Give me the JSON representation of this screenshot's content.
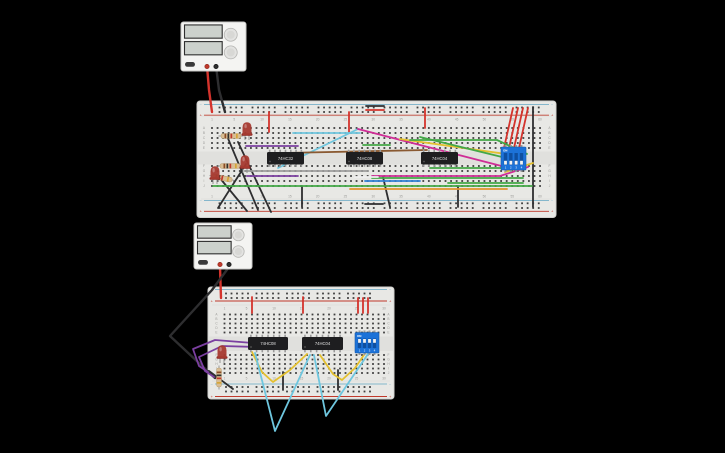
{
  "scene": {
    "width": 725,
    "height": 453,
    "background": "#000000"
  },
  "colors": {
    "board": "#e8e8e5",
    "board_edge": "#d2d2cf",
    "channel": "#e0e0dd",
    "hole": "#3f3f3f",
    "rail_red": "#c0392b",
    "rail_blue": "#85b7cc",
    "label": "#9b9b98",
    "divider": "#d9d9d6",
    "ic_body": "#1e1e20",
    "ic_pin": "#9a9a9a",
    "ic_label": "#e0e0e0",
    "dip_body": "#1c72d8",
    "dip_slot": "#0e4fa0",
    "dip_slider": "#f2f2f2",
    "dip_text": "#ffffff",
    "led_body": "#a63a30",
    "led_flange": "#8c2520",
    "led_lead": "#8a8a8a",
    "resistor_body": "#d9bd93",
    "resistor_lead": "#9a9a9a",
    "psu_body": "#f4f4f2",
    "psu_edge": "#c9c9c6",
    "psu_display": "#ccd1cc",
    "psu_display_edge": "#2e2e2e",
    "psu_knob": "#e3e3e1",
    "psu_knob_edge": "#b5b5b2",
    "psu_button": "#3a3a3a",
    "terminal_red": "#c0392b",
    "terminal_black": "#2e2e2e"
  },
  "wire_colors": {
    "red": "#d4332c",
    "black": "#2e2e30",
    "cyan": "#6ec6de",
    "magenta": "#cf2d96",
    "yellow": "#e3c02f",
    "green": "#43a847",
    "purple": "#7b3fa0",
    "gray": "#9c9c9c",
    "white": "#efefef",
    "blue": "#2f7fd6",
    "orange": "#e0932e",
    "brown": "#8a5a32"
  },
  "row_letters": [
    "A",
    "B",
    "C",
    "D",
    "E",
    "F",
    "G",
    "H",
    "I",
    "J"
  ],
  "rail_symbols": {
    "minus": "−",
    "plus": "+"
  },
  "breadboards": [
    {
      "name": "breadboard-1",
      "x": 197,
      "y": 101,
      "w": 359,
      "h": 116.5,
      "channel": [
        151.5,
        164.5
      ],
      "main": {
        "x0": 212,
        "pitch": 5.56,
        "cols": 60,
        "rows_top": [
          128,
          133,
          138,
          143,
          148
        ],
        "rows_bottom": [
          166,
          171,
          176,
          181,
          186
        ]
      },
      "rails": {
        "x0": 219.5,
        "group_pitch": 33,
        "groups": 10,
        "pitch": 5.56,
        "rows_top": [
          107.5,
          112
        ],
        "rows_bottom": [
          203.3,
          208
        ]
      },
      "lines": {
        "top_minus": 104.5,
        "top_plus": 115.2,
        "bottom_minus": 200.5,
        "bottom_plus": 211.3
      },
      "col_values": [
        1,
        5,
        10,
        15,
        20,
        25,
        30,
        35,
        40,
        45,
        50,
        55,
        60
      ],
      "col_label_y": [
        119.5,
        196.5
      ],
      "letter_x": [
        204,
        549.5
      ]
    },
    {
      "name": "breadboard-2",
      "x": 208,
      "y": 287,
      "w": 186,
      "h": 112,
      "channel": [
        336.5,
        351
      ],
      "main": {
        "x0": 224.5,
        "pitch": 5.5,
        "cols": 30,
        "rows_top": [
          314.5,
          319,
          323.5,
          328,
          332.5
        ],
        "rows_bottom": [
          355,
          359.5,
          364,
          368.5,
          373
        ]
      },
      "rails": {
        "x0": 226,
        "group_pitch": 30.5,
        "groups": 5,
        "pitch": 5.5,
        "rows_top": [
          293.5,
          298
        ],
        "rows_bottom": [
          387,
          391.5
        ]
      },
      "lines": {
        "top_minus": 289.5,
        "top_plus": 301,
        "bottom_minus": 384,
        "bottom_plus": 396.5
      },
      "col_values": [
        1,
        5,
        10,
        15,
        20,
        25,
        30
      ],
      "col_label_y": [
        308.5,
        378.5
      ],
      "letter_x": [
        216.5,
        388.5
      ]
    }
  ],
  "power_supplies": [
    {
      "name": "power-supply-1",
      "x": 181,
      "y": 22,
      "w": 65,
      "h": 49
    },
    {
      "name": "power-supply-2",
      "x": 194,
      "y": 223,
      "w": 58,
      "h": 46
    }
  ],
  "ics": [
    {
      "name": "ic-74hc32",
      "label": "74HC32",
      "x": 267,
      "y": 152,
      "w": 37,
      "h": 12.5
    },
    {
      "name": "ic-74hc08",
      "label": "74HC08",
      "x": 346,
      "y": 152,
      "w": 37,
      "h": 12.5
    },
    {
      "name": "ic-74hc04",
      "label": "74HC04",
      "x": 421,
      "y": 152,
      "w": 37,
      "h": 12.5
    },
    {
      "name": "ic-74hc08-b",
      "label": "74HC08",
      "x": 248,
      "y": 337,
      "w": 40,
      "h": 13
    },
    {
      "name": "ic-74hc04-b",
      "label": "74HC04",
      "x": 302,
      "y": 337,
      "w": 41,
      "h": 13
    }
  ],
  "dip_switches": [
    {
      "name": "dip-switch-1",
      "x": 501,
      "y": 147,
      "w": 25,
      "h": 23,
      "on_label": "ON",
      "pin_labels": [
        "1",
        "2",
        "3",
        "4"
      ],
      "states": [
        "off",
        "off",
        "off",
        "off"
      ]
    },
    {
      "name": "dip-switch-2",
      "x": 355,
      "y": 332.5,
      "w": 24,
      "h": 20.5,
      "on_label": "ON",
      "pin_labels": [
        "1",
        "2",
        "3",
        "4"
      ],
      "states": [
        "on",
        "on",
        "on",
        "on"
      ]
    }
  ],
  "leds": [
    {
      "name": "led-1",
      "x": 247,
      "y": 129
    },
    {
      "name": "led-2",
      "x": 245,
      "y": 162
    },
    {
      "name": "led-3",
      "x": 215,
      "y": 173
    },
    {
      "name": "led-4",
      "x": 222,
      "y": 352
    }
  ],
  "resistors": [
    {
      "name": "resistor-1",
      "x1": 221,
      "y1": 136,
      "x2": 241,
      "y2": 136
    },
    {
      "name": "resistor-2",
      "x1": 220,
      "y1": 166,
      "x2": 240,
      "y2": 166
    },
    {
      "name": "resistor-3",
      "x1": 212,
      "y1": 176,
      "x2": 232,
      "y2": 180
    },
    {
      "name": "resistor-4",
      "x1": 219,
      "y1": 368,
      "x2": 219,
      "y2": 387
    }
  ],
  "resistor_bands": [
    "#8a4b25",
    "#2e2e2e",
    "#c0392b",
    "#d4a537"
  ],
  "wires": [
    {
      "name": "psu1-positive-lead",
      "color": "red",
      "width": 2.4,
      "pts": [
        [
          207,
          66
        ],
        [
          209,
          90
        ],
        [
          212,
          112
        ]
      ]
    },
    {
      "name": "psu1-negative-lead",
      "color": "black",
      "width": 2.4,
      "pts": [
        [
          216,
          66
        ],
        [
          219,
          90
        ],
        [
          225,
          112
        ]
      ]
    },
    {
      "name": "b1-red-jumper-1",
      "color": "red",
      "pts": [
        [
          269,
          112
        ],
        [
          269,
          132
        ]
      ]
    },
    {
      "name": "b1-red-jumper-2",
      "color": "red",
      "pts": [
        [
          349,
          112
        ],
        [
          349,
          132
        ]
      ]
    },
    {
      "name": "b1-red-jumper-3",
      "color": "red",
      "pts": [
        [
          425,
          108
        ],
        [
          425,
          128
        ]
      ]
    },
    {
      "name": "b1-rail-bridge-red",
      "color": "red",
      "pts": [
        [
          366,
          110
        ],
        [
          384,
          110
        ]
      ]
    },
    {
      "name": "b1-rail-bridge-black",
      "color": "black",
      "pts": [
        [
          366,
          106
        ],
        [
          384,
          106
        ]
      ]
    },
    {
      "name": "b1-dip-feed-red-1",
      "color": "red",
      "pts": [
        [
          513,
          108
        ],
        [
          504,
          148
        ]
      ]
    },
    {
      "name": "b1-dip-feed-red-2",
      "color": "red",
      "pts": [
        [
          518,
          108
        ],
        [
          509,
          148
        ]
      ]
    },
    {
      "name": "b1-dip-feed-red-3",
      "color": "red",
      "pts": [
        [
          523,
          108
        ],
        [
          514,
          148
        ]
      ]
    },
    {
      "name": "b1-dip-feed-red-4",
      "color": "red",
      "pts": [
        [
          528,
          108
        ],
        [
          519,
          148
        ]
      ]
    },
    {
      "name": "b1-ground-bus-black",
      "color": "black",
      "pts": [
        [
          533,
          107
        ],
        [
          533,
          207
        ]
      ]
    },
    {
      "name": "b1-black-jumper-1",
      "color": "black",
      "pts": [
        [
          302,
          186
        ],
        [
          302,
          207
        ]
      ]
    },
    {
      "name": "b1-black-jumper-2",
      "color": "black",
      "pts": [
        [
          383,
          177
        ],
        [
          390,
          207
        ]
      ]
    },
    {
      "name": "b1-black-jumper-3",
      "color": "black",
      "pts": [
        [
          458,
          186
        ],
        [
          458,
          207
        ]
      ]
    },
    {
      "name": "b1-rail-bridge-black-bottom",
      "color": "black",
      "pts": [
        [
          365,
          204
        ],
        [
          383,
          204
        ]
      ]
    },
    {
      "name": "b1-led-ground-1",
      "color": "black",
      "pts": [
        [
          227,
          136
        ],
        [
          258,
          210
        ]
      ]
    },
    {
      "name": "b1-led-ground-2",
      "color": "black",
      "pts": [
        [
          238,
          142
        ],
        [
          271,
          212
        ]
      ]
    },
    {
      "name": "b1-led-ground-3",
      "color": "black",
      "pts": [
        [
          219,
          177
        ],
        [
          247,
          211
        ]
      ]
    },
    {
      "name": "b1-led-ground-4",
      "color": "black",
      "pts": [
        [
          246,
          164
        ],
        [
          218,
          208
        ]
      ]
    },
    {
      "name": "b1-cyan-row-b",
      "color": "cyan",
      "pts": [
        [
          293,
          133
        ],
        [
          360,
          133
        ]
      ]
    },
    {
      "name": "b1-cyan-diagonal",
      "color": "cyan",
      "pts": [
        [
          278,
          168
        ],
        [
          358,
          129
        ]
      ]
    },
    {
      "name": "b1-magenta-diagonal",
      "color": "magenta",
      "pts": [
        [
          358,
          129
        ],
        [
          517,
          170
        ]
      ]
    },
    {
      "name": "b1-magenta-row-h",
      "color": "magenta",
      "pts": [
        [
          372,
          176
        ],
        [
          500,
          176
        ],
        [
          528,
          167
        ]
      ]
    },
    {
      "name": "b1-yellow-diagonal",
      "color": "yellow",
      "pts": [
        [
          400,
          139
        ],
        [
          520,
          156
        ]
      ]
    },
    {
      "name": "b1-yellow-short",
      "color": "yellow",
      "pts": [
        [
          505,
          172
        ],
        [
          533,
          163
        ]
      ]
    },
    {
      "name": "b1-green-row-c",
      "color": "green",
      "pts": [
        [
          410,
          140
        ],
        [
          497,
          140
        ],
        [
          527,
          154
        ]
      ]
    },
    {
      "name": "b1-green-diagonal",
      "color": "green",
      "pts": [
        [
          420,
          137
        ],
        [
          502,
          157
        ]
      ]
    },
    {
      "name": "b1-green-short-d",
      "color": "green",
      "pts": [
        [
          363,
          145
        ],
        [
          390,
          145
        ]
      ]
    },
    {
      "name": "b1-green-row-f",
      "color": "green",
      "pts": [
        [
          430,
          168
        ],
        [
          520,
          168
        ]
      ]
    },
    {
      "name": "b1-green-row-h",
      "color": "green",
      "pts": [
        [
          372,
          178
        ],
        [
          523,
          178
        ]
      ]
    },
    {
      "name": "b1-green-row-i",
      "color": "green",
      "pts": [
        [
          448,
          183
        ],
        [
          523,
          183
        ]
      ]
    },
    {
      "name": "b1-green-row-j",
      "color": "green",
      "pts": [
        [
          213,
          186
        ],
        [
          532,
          186
        ]
      ]
    },
    {
      "name": "b1-purple-row-d",
      "color": "purple",
      "pts": [
        [
          246,
          146
        ],
        [
          298,
          146
        ]
      ]
    },
    {
      "name": "b1-purple-row-h",
      "color": "purple",
      "pts": [
        [
          247,
          176
        ],
        [
          298,
          176
        ]
      ]
    },
    {
      "name": "b1-gray-row-g",
      "color": "gray",
      "pts": [
        [
          245,
          171
        ],
        [
          368,
          171
        ]
      ]
    },
    {
      "name": "b1-white-row-h",
      "color": "white",
      "pts": [
        [
          355,
          177
        ],
        [
          378,
          177
        ]
      ]
    },
    {
      "name": "b1-blue-row-i",
      "color": "blue",
      "pts": [
        [
          365,
          181
        ],
        [
          420,
          181
        ]
      ]
    },
    {
      "name": "b1-orange-row",
      "color": "orange",
      "pts": [
        [
          350,
          189
        ],
        [
          507,
          189
        ]
      ]
    },
    {
      "name": "b1-brown-row-e",
      "color": "brown",
      "pts": [
        [
          283,
          153
        ],
        [
          427,
          150
        ]
      ]
    },
    {
      "name": "psu2-positive-lead",
      "color": "red",
      "width": 2.4,
      "pts": [
        [
          220,
          267
        ],
        [
          221,
          298
        ]
      ]
    },
    {
      "name": "psu2-negative-lead",
      "color": "black",
      "width": 2.4,
      "pts": [
        [
          229,
          267
        ],
        [
          212,
          290
        ],
        [
          170,
          336
        ],
        [
          215,
          378
        ]
      ]
    },
    {
      "name": "b2-red-jumper-1",
      "color": "red",
      "pts": [
        [
          252,
          297
        ],
        [
          252,
          313
        ]
      ]
    },
    {
      "name": "b2-red-jumper-2",
      "color": "red",
      "pts": [
        [
          303,
          297
        ],
        [
          303,
          313
        ]
      ]
    },
    {
      "name": "b2-red-jumper-3",
      "color": "red",
      "pts": [
        [
          358,
          298
        ],
        [
          358,
          313
        ]
      ]
    },
    {
      "name": "b2-red-jumper-4",
      "color": "red",
      "pts": [
        [
          363,
          298
        ],
        [
          363,
          313
        ]
      ]
    },
    {
      "name": "b2-red-jumper-5",
      "color": "red",
      "pts": [
        [
          368,
          298
        ],
        [
          368,
          313
        ]
      ]
    },
    {
      "name": "b2-black-short",
      "color": "black",
      "pts": [
        [
          209,
          371
        ],
        [
          233,
          389
        ]
      ]
    },
    {
      "name": "b2-black-jumper-1",
      "color": "black",
      "pts": [
        [
          283,
          372
        ],
        [
          283,
          390
        ]
      ]
    },
    {
      "name": "b2-black-jumper-2",
      "color": "black",
      "pts": [
        [
          338,
          370
        ],
        [
          338,
          390
        ]
      ]
    },
    {
      "name": "b2-purple-loop-1",
      "color": "purple",
      "pts": [
        [
          253,
          343
        ],
        [
          215,
          340
        ],
        [
          193,
          349
        ],
        [
          199,
          366
        ],
        [
          208,
          372
        ]
      ]
    },
    {
      "name": "b2-purple-loop-2",
      "color": "purple",
      "pts": [
        [
          257,
          347
        ],
        [
          222,
          346
        ],
        [
          199,
          357
        ],
        [
          205,
          371
        ],
        [
          214,
          377
        ]
      ]
    },
    {
      "name": "b2-yellow-u-1",
      "color": "yellow",
      "pts": [
        [
          252,
          352
        ],
        [
          262,
          372
        ],
        [
          273,
          382
        ],
        [
          290,
          370
        ],
        [
          307,
          354
        ]
      ]
    },
    {
      "name": "b2-yellow-u-2",
      "color": "yellow",
      "pts": [
        [
          320,
          355
        ],
        [
          333,
          374
        ],
        [
          342,
          380
        ],
        [
          355,
          368
        ],
        [
          366,
          352
        ]
      ]
    },
    {
      "name": "b2-cyan-v-1",
      "color": "cyan",
      "pts": [
        [
          255,
          353
        ],
        [
          275,
          431
        ],
        [
          310,
          355
        ]
      ]
    },
    {
      "name": "b2-cyan-v-2",
      "color": "cyan",
      "pts": [
        [
          314,
          355
        ],
        [
          326,
          416
        ],
        [
          370,
          351
        ]
      ]
    }
  ]
}
